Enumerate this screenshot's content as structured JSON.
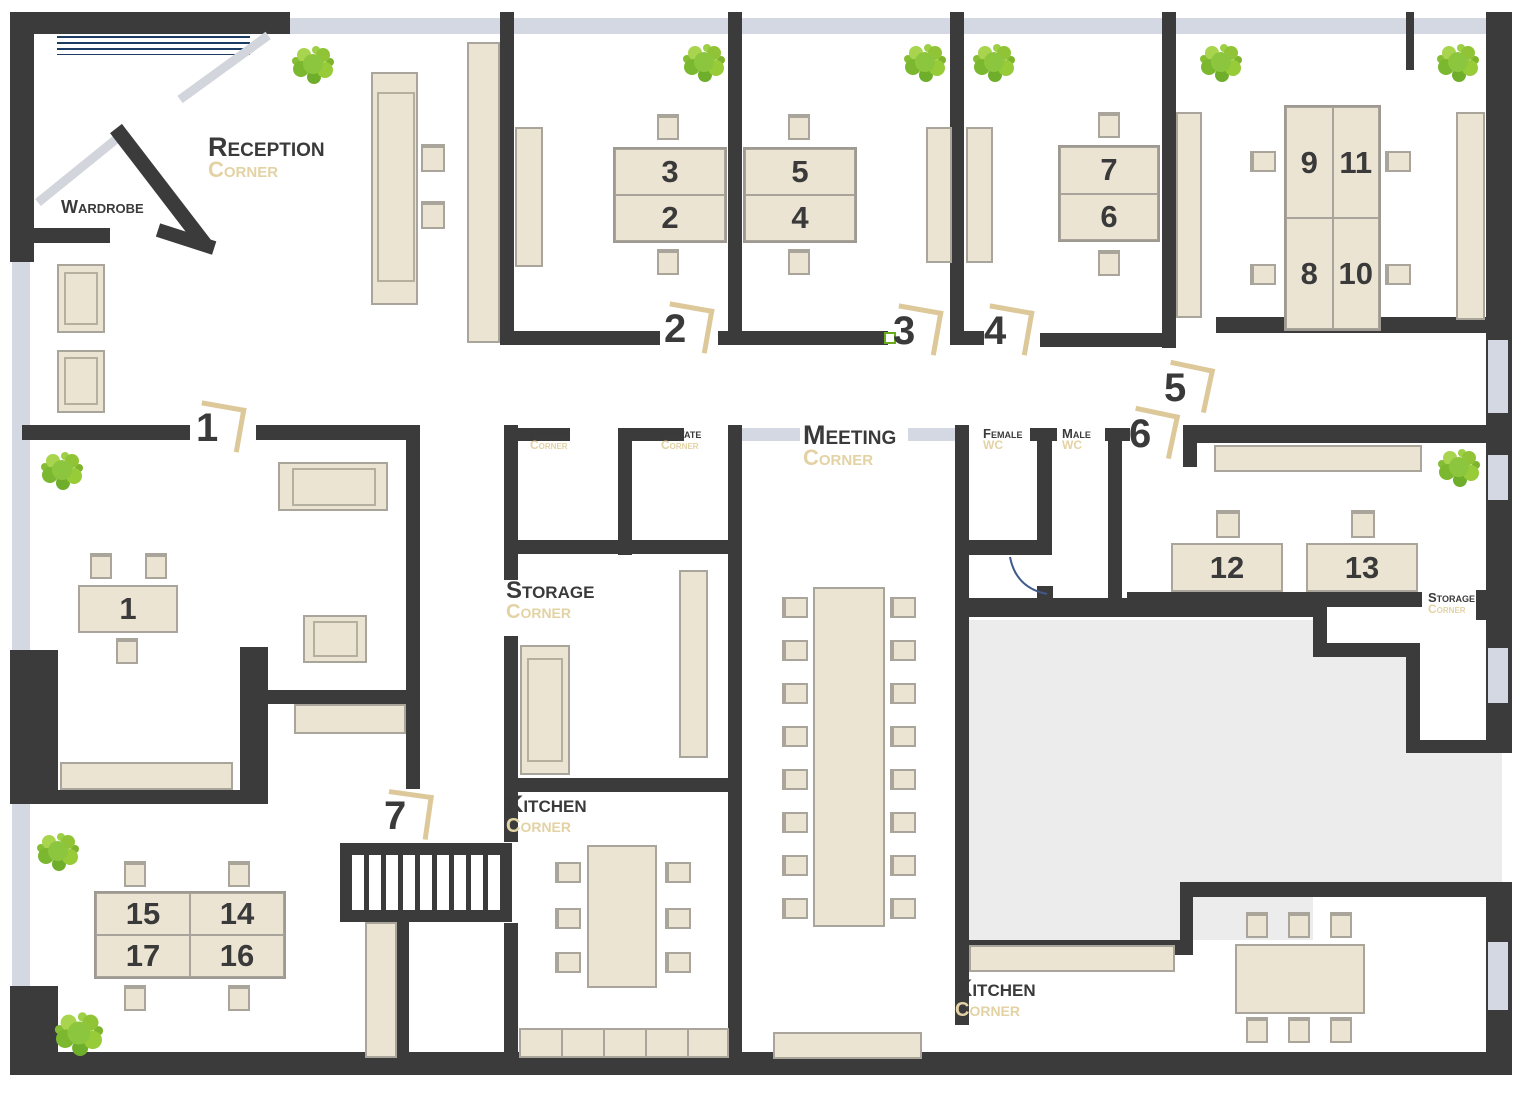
{
  "title": "Office floor plan with numbered workplaces",
  "palette": {
    "wall": "#3b3b3b",
    "furniture_fill": "#ece4d2",
    "furniture_border": "#aaa59b",
    "window_strip": "#d4d8e2",
    "courtyard": "#ececec",
    "door_bracket": "#ddc89a",
    "label_dark": "#3a3a3a",
    "label_beige": "#e3d2a4",
    "bush_green": "#8cc63e",
    "navy": "#1d3c63",
    "door3_marker_green": "#6aaa1e"
  },
  "rooms": {
    "reception": {
      "name": "Reception",
      "sub": "Corner"
    },
    "wardrobe": {
      "name": "Wardrobe"
    },
    "private_1": {
      "name": "Private",
      "sub": "Corner"
    },
    "private_2": {
      "name": "Private",
      "sub": "Corner"
    },
    "meeting": {
      "name": "Meeting",
      "sub": "Corner"
    },
    "female_wc": {
      "name": "Female",
      "sub": "WC"
    },
    "male_wc": {
      "name": "Male",
      "sub": "WC"
    },
    "storage_left": {
      "name": "Storage",
      "sub": "Corner"
    },
    "storage_right": {
      "name": "Storage",
      "sub": "Corner"
    },
    "kitchen_left": {
      "name": "Kitchen",
      "sub": "Corner"
    },
    "kitchen_right": {
      "name": "Kitchen",
      "sub": "Corner"
    }
  },
  "doors": {
    "d1": "1",
    "d2": "2",
    "d3": "3",
    "d4": "4",
    "d5": "5",
    "d6": "6",
    "d7": "7"
  },
  "desks": {
    "n1": "1",
    "n2": "2",
    "n3": "3",
    "n4": "4",
    "n5": "5",
    "n6": "6",
    "n7": "7",
    "n8": "8",
    "n9": "9",
    "n10": "10",
    "n11": "11",
    "n12": "12",
    "n13": "13",
    "n14": "14",
    "n15": "15",
    "n16": "16",
    "n17": "17"
  }
}
